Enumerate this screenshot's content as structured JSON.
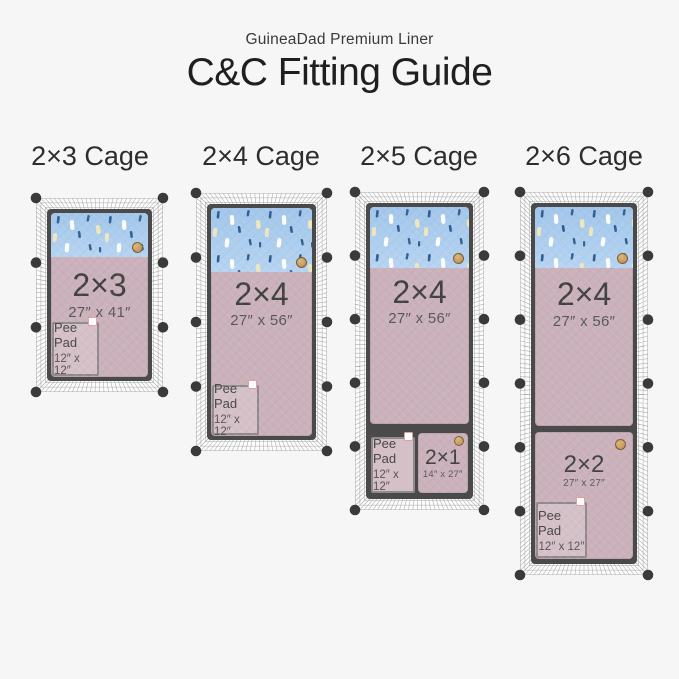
{
  "header": {
    "brand": "GuineaDad Premium Liner",
    "title": "C&C Fitting Guide"
  },
  "pee_pad": {
    "label": "Pee Pad",
    "size": "12″ x 12″"
  },
  "colors": {
    "sky_blue": "#a9cbee",
    "liner_mauve": "#cab1bb",
    "cage_frame": "#4a4a4a",
    "connector_ball": "#3a3a3a",
    "logo_gold": "#c29a5d"
  },
  "cages": [
    {
      "heading": "2×3 Cage",
      "rows": 3,
      "cols": 2,
      "liners": [
        {
          "size": "2×3",
          "dims": "27″ x 41″"
        }
      ]
    },
    {
      "heading": "2×4 Cage",
      "rows": 4,
      "cols": 2,
      "liners": [
        {
          "size": "2×4",
          "dims": "27″ x 56″"
        }
      ]
    },
    {
      "heading": "2×5 Cage",
      "rows": 5,
      "cols": 2,
      "liners": [
        {
          "size": "2×4",
          "dims": "27″ x 56″"
        },
        {
          "size": "2×1",
          "dims": "14″ x 27″"
        }
      ]
    },
    {
      "heading": "2×6 Cage",
      "rows": 6,
      "cols": 2,
      "liners": [
        {
          "size": "2×4",
          "dims": "27″ x 56″"
        },
        {
          "size": "2×2",
          "dims": "27″ x 27″"
        }
      ]
    }
  ]
}
